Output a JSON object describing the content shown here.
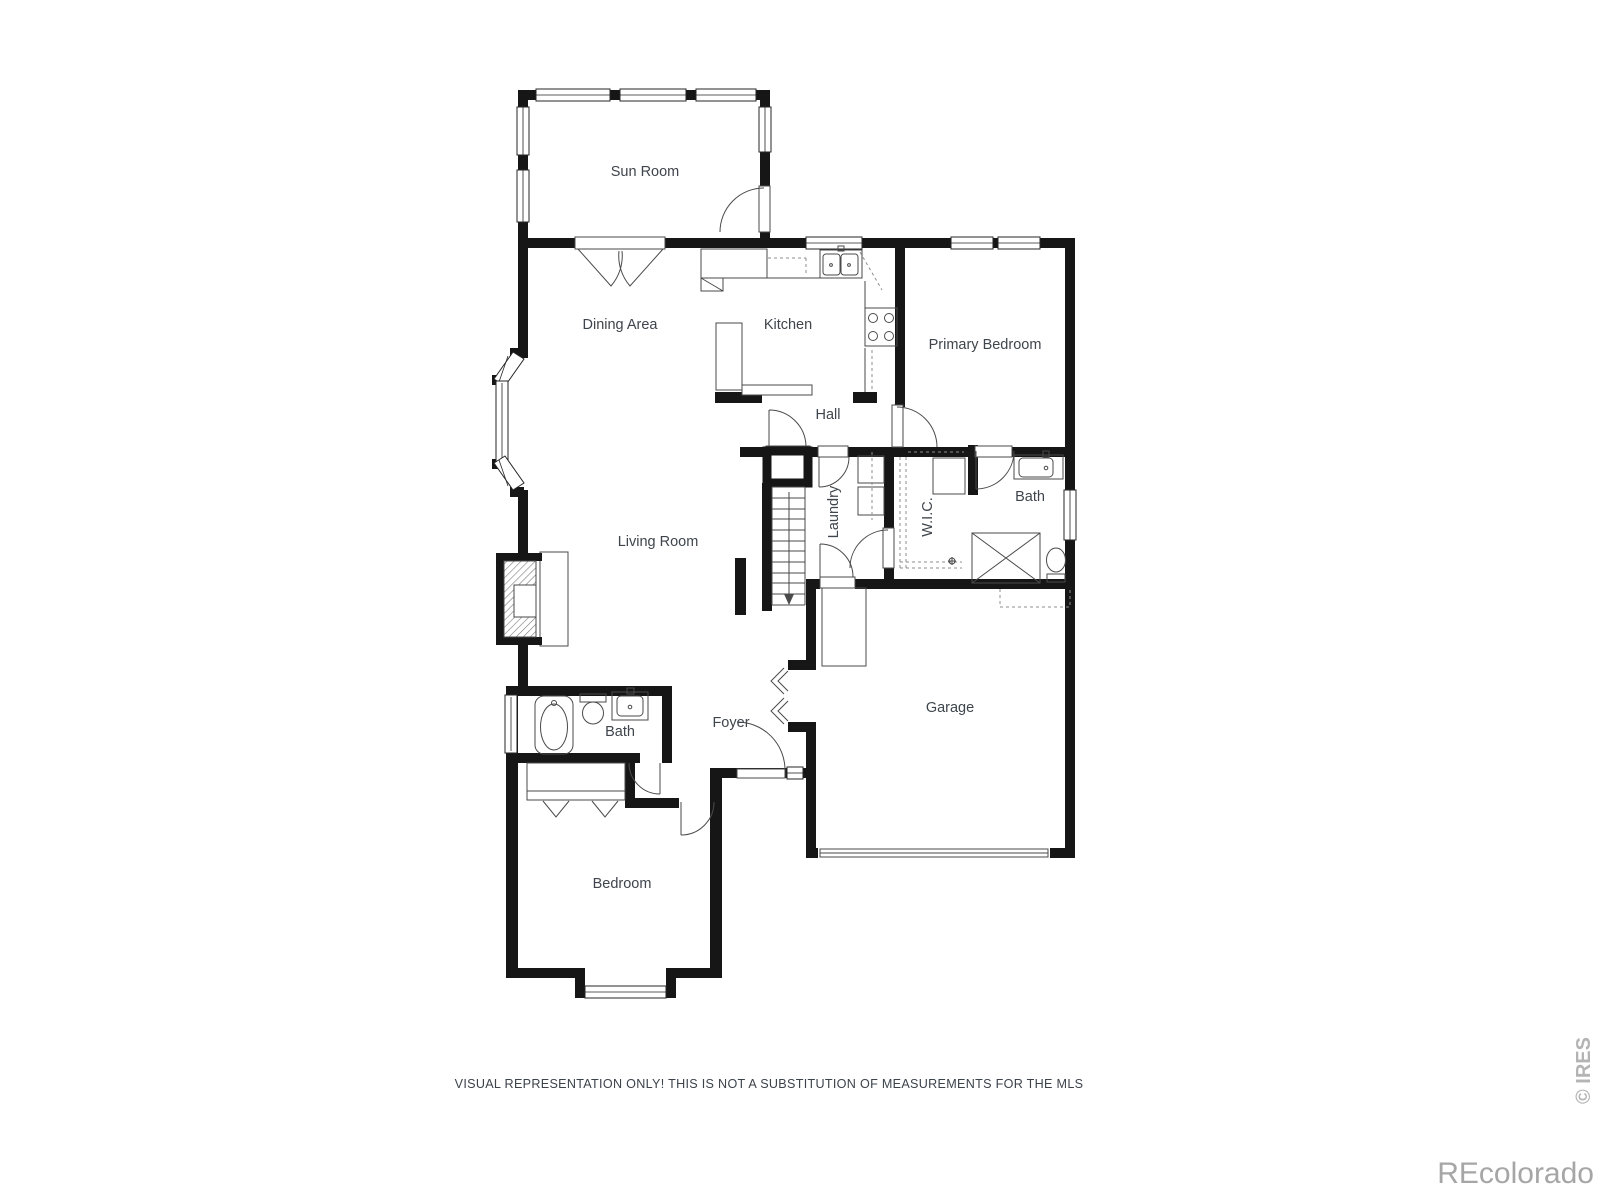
{
  "page": {
    "background": "#ffffff"
  },
  "floor_plan": {
    "room_labels": {
      "sun_room": "Sun Room",
      "dining_area": "Dining Area",
      "kitchen": "Kitchen",
      "primary_bedroom": "Primary Bedroom",
      "hall": "Hall",
      "laundry": "Laundry",
      "wic": "W.I.C.",
      "bath_upper": "Bath",
      "living_room": "Living Room",
      "foyer": "Foyer",
      "garage": "Garage",
      "bath_lower": "Bath",
      "bedroom": "Bedroom"
    },
    "fixtures": {
      "stove": "4-burner stove",
      "kitchen_sink": "double-basin sink",
      "island": "kitchen island counter",
      "washer_dryer": "washer and dryer",
      "shower": "shower stall",
      "vanity_sink": "bathroom vanity sink",
      "toilet": "toilet",
      "bathtub": "bathtub",
      "fireplace": "fireplace",
      "stairs": "stairs down",
      "garage_door": "garage door",
      "closet": "closet with bifold doors"
    },
    "colors": {
      "wall": "#161616",
      "fixture_line": "#4a4a4a",
      "dashed_line": "#8c8c8c",
      "label_text": "#3e454c",
      "watermark": "#a6a6a6"
    }
  },
  "footer": {
    "disclaimer": "VISUAL REPRESENTATION ONLY! THIS IS NOT A SUBSTITUTION OF MEASUREMENTS FOR THE MLS"
  },
  "watermarks": {
    "ires": "© IRES",
    "brand": "REcolorado"
  }
}
